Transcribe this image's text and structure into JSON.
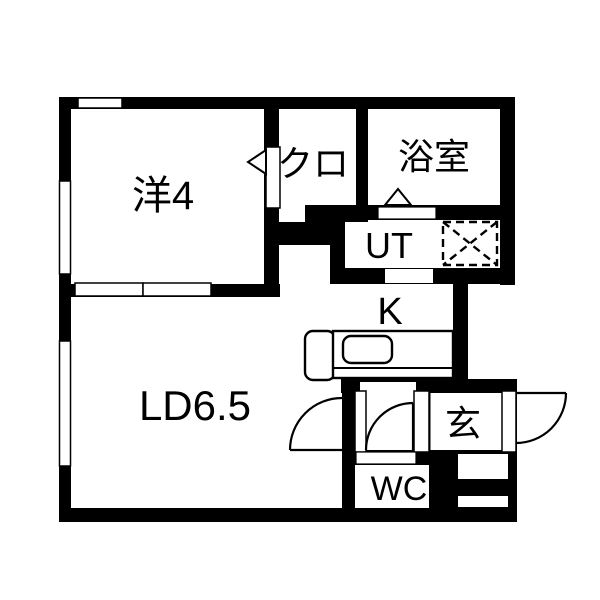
{
  "floorplan": {
    "title": "1LDK floor plan",
    "rooms": {
      "western_room": {
        "label": "洋4"
      },
      "closet": {
        "label": "クロ"
      },
      "bathroom": {
        "label": "浴室"
      },
      "utility": {
        "label": "UT"
      },
      "kitchen": {
        "label": "K"
      },
      "living_dining": {
        "label": "LD6.5"
      },
      "entrance": {
        "label": "玄"
      },
      "toilet": {
        "label": "WC"
      }
    },
    "colors": {
      "wall": "#000000",
      "floor": "#ffffff",
      "line": "#000000"
    }
  }
}
